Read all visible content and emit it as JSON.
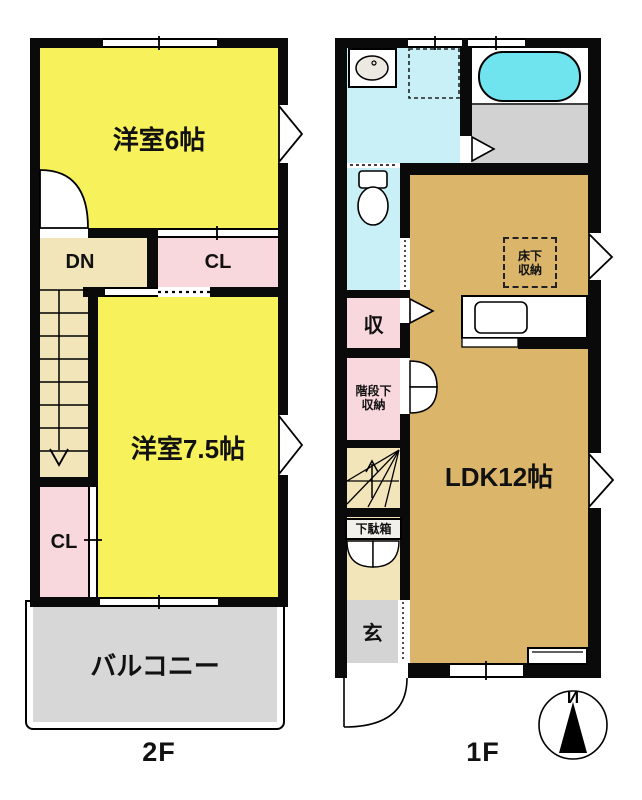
{
  "plan_title": "2-story house floor plan",
  "floor2": {
    "label": "2F",
    "bedroom6": "洋室6帖",
    "down": "DN",
    "closet_top": "CL",
    "bedroom75": "洋室7.5帖",
    "closet_bottom": "CL",
    "balcony": "バルコニー"
  },
  "floor1": {
    "label": "1F",
    "ldk": "LDK12帖",
    "storage": "収",
    "under_stair_storage_line1": "階段下",
    "under_stair_storage_line2": "収納",
    "underfloor_storage_line1": "床下",
    "underfloor_storage_line2": "収納",
    "shoe_cabinet": "下駄箱",
    "entrance": "玄",
    "compass_north": "И"
  },
  "colors": {
    "wall": "#0a0a0a",
    "room_yellow": "#f7f25b",
    "hall_cream": "#f3e5ba",
    "closet_pink": "#f9d8dd",
    "ldk_tan": "#dbb56a",
    "water_cyan": "#c9f0f7",
    "tub_cyan": "#6fe4ef",
    "balcony_gray": "#d7d7d7",
    "bath_floor_gray": "#d2d2d2",
    "entrance_gray": "#d4d4d4"
  }
}
